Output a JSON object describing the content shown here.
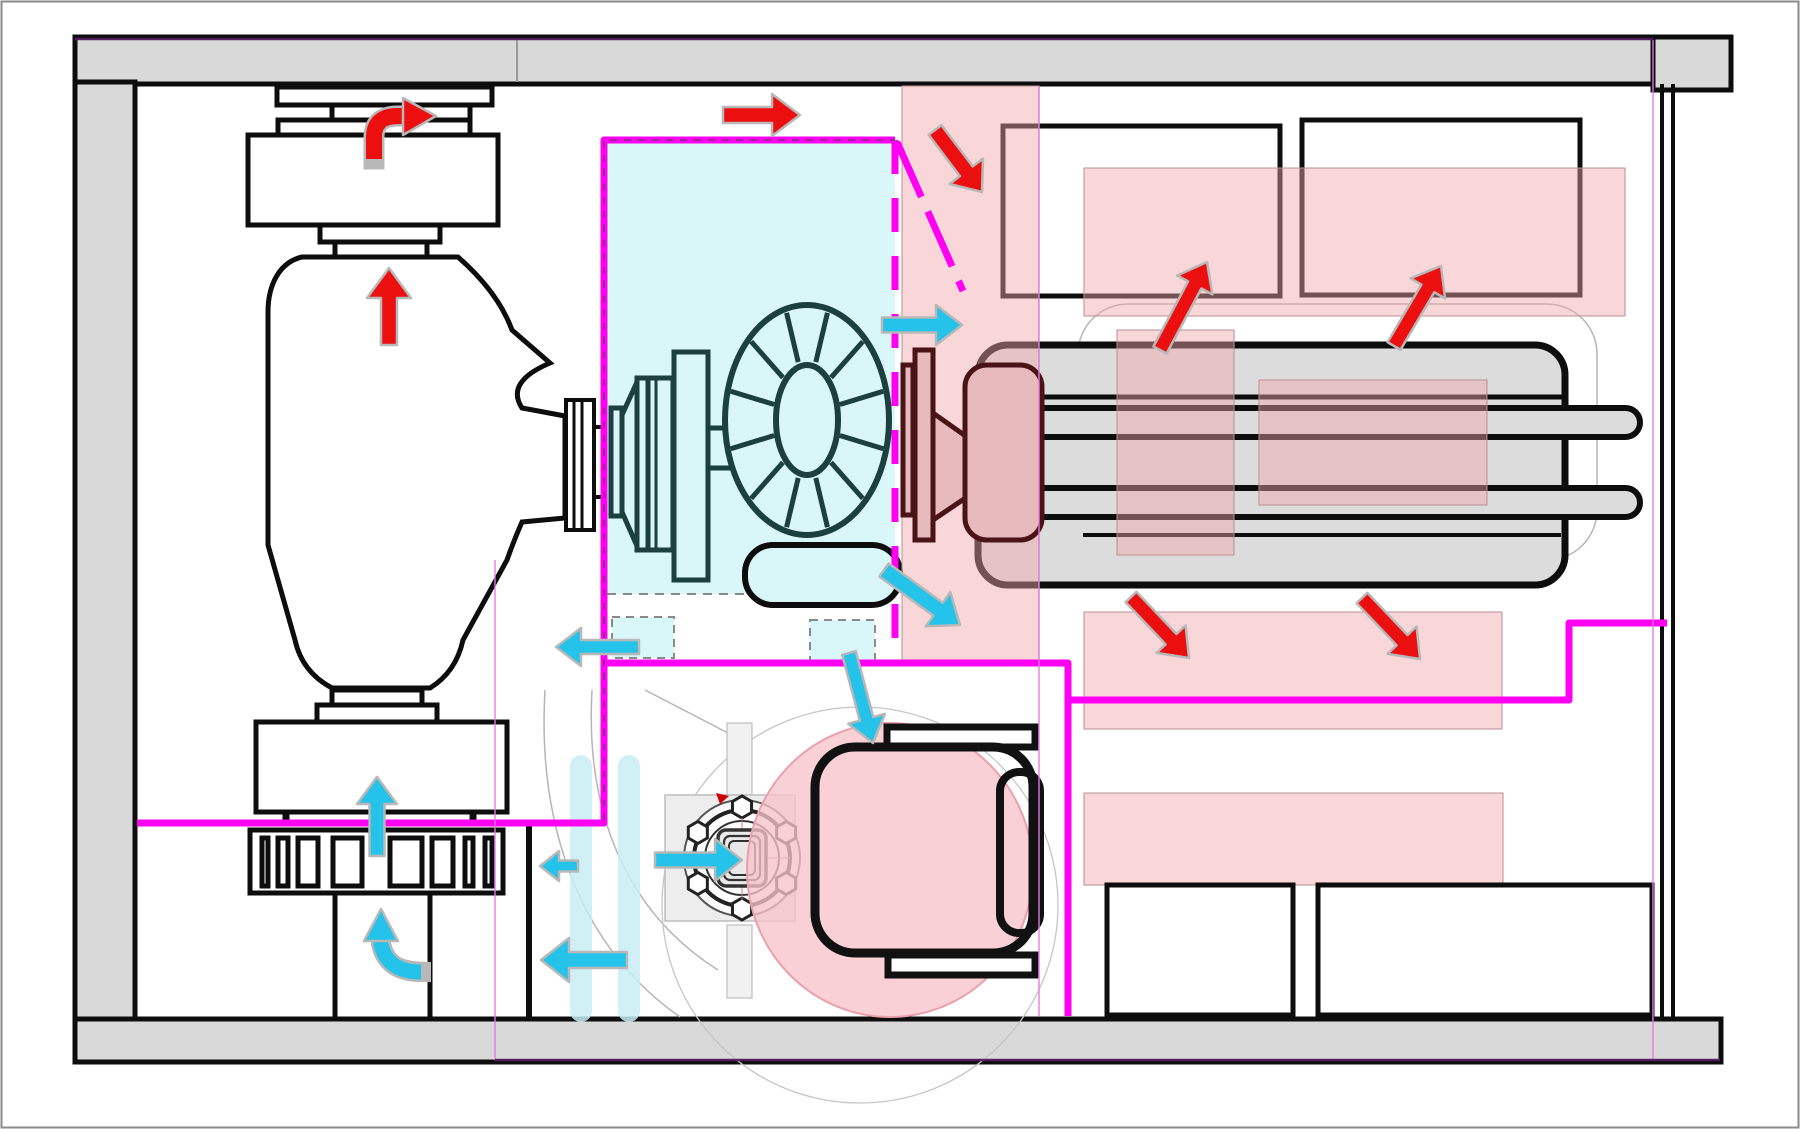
{
  "diagram": {
    "kind": "engine-compartment-airflow-plan",
    "canvas": {
      "width": 1800,
      "height": 1129
    }
  },
  "palette": {
    "ink": "#0d0d0d",
    "wall_gray": "#d9d9d9",
    "magenta": "#ff00f2",
    "guide_violet": "#e07ce0",
    "purple_line": "#551a5e",
    "cold_fill": "#d9f6f9",
    "cold_bar": "#c8edf5",
    "hot_zone": "#f2a3a8",
    "blob_fill": "#f6c3cb",
    "blob_stroke": "#e9a0ac",
    "cold_arrow": "#25c3e9",
    "hot_arrow": "#ec0f0f",
    "arrow_outline": "#b8b8b8",
    "teal": "#1c3f40",
    "engine_gray": "#dcdcdc",
    "dusty_fill": "#e7babd",
    "brown": "#4a1316",
    "faint": "#b5b5b5"
  },
  "zones": {
    "hot_rects": [
      {
        "name": "hot-zone-exhaust-strip",
        "x": 902,
        "y": 86,
        "w": 137,
        "h": 576
      },
      {
        "name": "hot-zone-top-band",
        "x": 1084,
        "y": 168,
        "w": 541,
        "h": 148
      },
      {
        "name": "hot-zone-mid-band",
        "x": 1084,
        "y": 612,
        "w": 418,
        "h": 117
      },
      {
        "name": "hot-zone-lower-band",
        "x": 1084,
        "y": 793,
        "w": 419,
        "h": 92
      },
      {
        "name": "hot-overlay-engine-left",
        "x": 1117,
        "y": 330,
        "w": 117,
        "h": 225
      },
      {
        "name": "hot-overlay-engine-right",
        "x": 1259,
        "y": 380,
        "w": 228,
        "h": 125
      }
    ],
    "hot_blob": {
      "name": "hot-blob-turbine",
      "cx": 890,
      "cy": 870,
      "rx": 143,
      "ry": 147
    },
    "cold_plenum": {
      "name": "cold-plenum",
      "x": 607,
      "y": 140,
      "w": 288,
      "h": 454
    },
    "cold_bars": [
      {
        "name": "cold-duct-bar-left",
        "x": 570,
        "y": 755,
        "w": 22,
        "h": 267
      },
      {
        "name": "cold-duct-bar-right",
        "x": 618,
        "y": 755,
        "w": 22,
        "h": 267
      }
    ],
    "cold_dashed_boxes": [
      {
        "name": "cold-leak-box-left",
        "x": 612,
        "y": 617,
        "w": 62,
        "h": 41
      },
      {
        "name": "cold-leak-box-right",
        "x": 810,
        "y": 620,
        "w": 65,
        "h": 41
      }
    ]
  },
  "partition_walls": {
    "solid": [
      {
        "name": "wall-plenum-left-top",
        "d": "M 137,823 H 604 V 140 H 895"
      },
      {
        "name": "wall-lower-compartment",
        "d": "M 604,663 H 1068 V 1016"
      },
      {
        "name": "wall-right-branch",
        "d": "M 1068,700 H 1569 V 623 H 1667"
      }
    ],
    "dashed": [
      {
        "name": "wall-plenum-right-dashed",
        "d": "M 895,140 V 663",
        "dash": "34 24"
      },
      {
        "name": "wall-diagonal-deflector",
        "d": "M 897,142 L 963,291",
        "dash": "60 16"
      }
    ],
    "centerline": {
      "name": "wall-centerline",
      "d": "M 604,820 V 140 H 895",
      "dash": "7 7"
    }
  },
  "guides": {
    "vertical": [
      {
        "name": "guide-section-a",
        "x": 495,
        "y1": 560,
        "y2": 1060
      },
      {
        "name": "guide-section-b",
        "x": 1039,
        "y1": 86,
        "y2": 1016
      },
      {
        "name": "guide-section-c",
        "x": 1653,
        "y1": 40,
        "y2": 1060
      }
    ],
    "horizontal": [
      {
        "name": "guide-top-purple",
        "y": 39,
        "x1": 75,
        "x2": 1653
      },
      {
        "name": "guide-bottom-purple",
        "y": 1060,
        "x1": 495,
        "x2": 1720
      }
    ]
  },
  "flow_arrows": {
    "hot": [
      {
        "name": "hot-arrow-up-into-muffler",
        "x1": 389,
        "y1": 345,
        "x2": 389,
        "y2": 268,
        "shaft": 16,
        "head_w": 44,
        "head_l": 30
      },
      {
        "name": "hot-arrow-top-right",
        "x1": 723,
        "y1": 115,
        "x2": 800,
        "y2": 115,
        "shaft": 16,
        "head_w": 42,
        "head_l": 28
      },
      {
        "name": "hot-arrow-into-strip",
        "x1": 935,
        "y1": 130,
        "x2": 982,
        "y2": 192,
        "shaft": 16,
        "head_w": 42,
        "head_l": 26
      },
      {
        "name": "hot-arrow-box1",
        "x1": 1160,
        "y1": 350,
        "x2": 1207,
        "y2": 262,
        "shaft": 15,
        "head_w": 40,
        "head_l": 26
      },
      {
        "name": "hot-arrow-box2",
        "x1": 1394,
        "y1": 346,
        "x2": 1441,
        "y2": 266,
        "shaft": 15,
        "head_w": 40,
        "head_l": 26
      },
      {
        "name": "hot-arrow-midband-left",
        "x1": 1131,
        "y1": 597,
        "x2": 1189,
        "y2": 658,
        "shaft": 15,
        "head_w": 40,
        "head_l": 26
      },
      {
        "name": "hot-arrow-midband-right",
        "x1": 1362,
        "y1": 598,
        "x2": 1420,
        "y2": 659,
        "shaft": 15,
        "head_w": 40,
        "head_l": 26
      }
    ],
    "cold": [
      {
        "name": "cold-arrow-cross-bulkhead",
        "x1": 882,
        "y1": 325,
        "x2": 962,
        "y2": 325,
        "shaft": 15,
        "head_w": 40,
        "head_l": 26
      },
      {
        "name": "cold-arrow-capsule-out",
        "x1": 884,
        "y1": 570,
        "x2": 960,
        "y2": 625,
        "shaft": 16,
        "head_w": 42,
        "head_l": 27
      },
      {
        "name": "cold-arrow-down-to-blob",
        "x1": 849,
        "y1": 653,
        "x2": 873,
        "y2": 743,
        "shaft": 14,
        "head_w": 38,
        "head_l": 25
      },
      {
        "name": "cold-arrow-leak-left",
        "x1": 639,
        "y1": 647,
        "x2": 556,
        "y2": 647,
        "shaft": 14,
        "head_w": 38,
        "head_l": 25
      },
      {
        "name": "cold-arrow-small-left",
        "x1": 578,
        "y1": 866,
        "x2": 540,
        "y2": 866,
        "shaft": 11,
        "head_w": 30,
        "head_l": 19
      },
      {
        "name": "cold-arrow-into-flange",
        "x1": 655,
        "y1": 860,
        "x2": 742,
        "y2": 860,
        "shaft": 15,
        "head_w": 42,
        "head_l": 27
      },
      {
        "name": "cold-arrow-big-left",
        "x1": 627,
        "y1": 960,
        "x2": 541,
        "y2": 960,
        "shaft": 16,
        "head_w": 44,
        "head_l": 28
      },
      {
        "name": "cold-arrow-up-grille",
        "x1": 377,
        "y1": 856,
        "x2": 377,
        "y2": 777,
        "shaft": 15,
        "head_w": 40,
        "head_l": 27
      }
    ],
    "curved": [
      {
        "name": "hot-arrow-curved-exhaust",
        "type": "hot",
        "path": "M 374,159 V 137 Q 374,116 398,116 H 403",
        "shaft": 16,
        "head": [
          [
            403,
            98
          ],
          [
            436,
            116
          ],
          [
            403,
            135
          ]
        ]
      },
      {
        "name": "cold-arrow-curved-duct",
        "type": "cold",
        "path": "M 421,972 Q 387,972 381,944 V 939",
        "shaft": 15,
        "head": [
          [
            364,
            941
          ],
          [
            381,
            909
          ],
          [
            398,
            941
          ]
        ]
      }
    ]
  }
}
